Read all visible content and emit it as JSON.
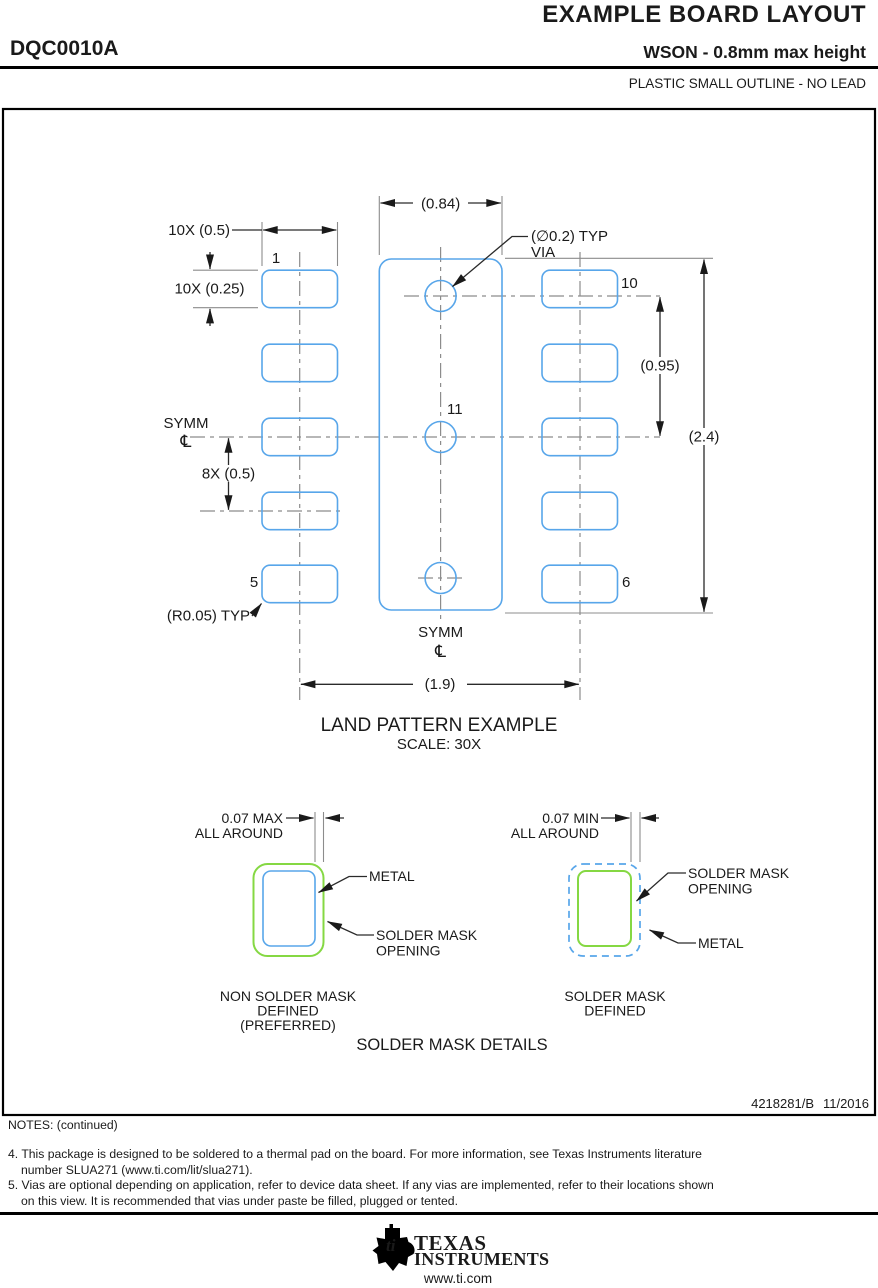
{
  "header": {
    "title": "EXAMPLE BOARD LAYOUT",
    "part_number": "DQC0010A",
    "subtitle": "WSON - 0.8mm max height",
    "package_type": "PLASTIC SMALL OUTLINE - NO LEAD"
  },
  "drawing": {
    "title": "LAND PATTERN EXAMPLE",
    "scale": "SCALE:  30X",
    "dims": {
      "pad_width": "10X (0.5)",
      "pad_height": "10X (0.25)",
      "pitch": "8X (0.5)",
      "center_pad_width": "(0.84)",
      "via_pitch": "(0.95)",
      "overall_height": "(2.4)",
      "row_spacing": "(1.9)",
      "via_dia_line1": "(∅0.2) TYP",
      "via_dia_line2": "VIA",
      "corner_radius": "(R0.05) TYP"
    },
    "pins": {
      "p1": "1",
      "p5": "5",
      "p6": "6",
      "p10": "10",
      "p11": "11"
    },
    "symm": "SYMM",
    "centerline_symbol": "℄"
  },
  "solder_mask": {
    "title": "SOLDER MASK DETAILS",
    "nsmd": {
      "clearance1": "0.07 MAX",
      "clearance2": "ALL AROUND",
      "metal": "METAL",
      "opening1": "SOLDER MASK",
      "opening2": "OPENING",
      "caption1": "NON SOLDER MASK",
      "caption2": "DEFINED",
      "caption3": "(PREFERRED)"
    },
    "smd": {
      "clearance1": "0.07 MIN",
      "clearance2": "ALL AROUND",
      "metal": "METAL",
      "opening1": "SOLDER MASK",
      "opening2": "OPENING",
      "caption1": "SOLDER MASK",
      "caption2": "DEFINED"
    }
  },
  "notes": {
    "heading": "NOTES: (continued)",
    "n4_l1": "4. This package is designed to be soldered to a thermal pad on the board. For more information, see Texas Instruments literature",
    "n4_l2": "number SLUA271 (www.ti.com/lit/slua271).",
    "n5_l1": "5. Vias are optional depending on application, refer to device data sheet. If any vias are implemented, refer to their locations shown",
    "n5_l2": "on this view. It is recommended that vias under paste be filled, plugged or tented."
  },
  "footer": {
    "doc_number": "4218281/B",
    "date": "11/2016",
    "brand1": "TEXAS",
    "brand2": "INSTRUMENTS",
    "website": "www.ti.com",
    "bug_text": "ti"
  },
  "colors": {
    "pad_blue": "#58a6ea",
    "mask_green": "#85d843",
    "line_dark": "#1a1a1a",
    "centerline_gray": "#8c8c8c"
  }
}
